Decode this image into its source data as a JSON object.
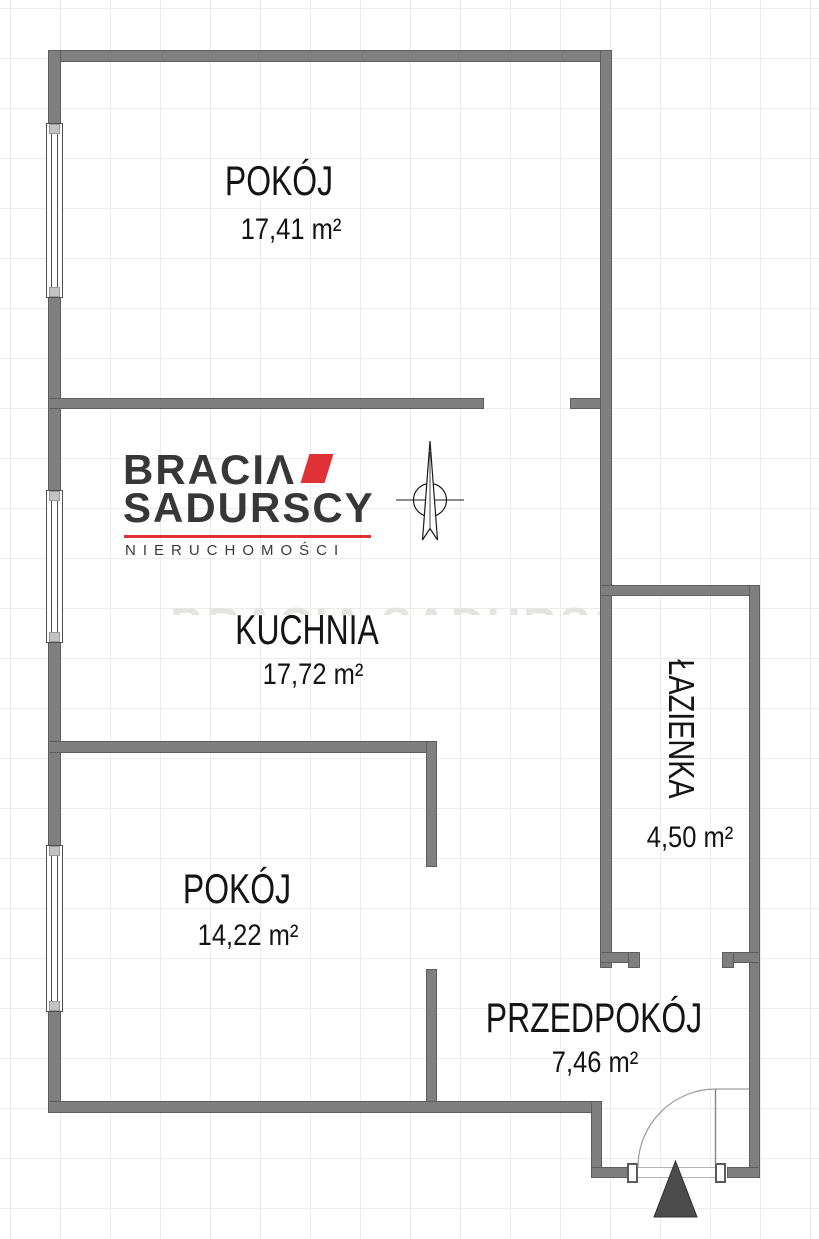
{
  "branding": {
    "logo_line1": "BRACIΛ",
    "logo_line2": "SADURSCY",
    "logo_tagline": "NIERUCHOMOŚCI",
    "watermark_text": "BRACIA SADURSCY"
  },
  "rooms": [
    {
      "name": "POKÓJ",
      "area": "17,41 m²"
    },
    {
      "name": "KUCHNIA",
      "area": "17,72 m²"
    },
    {
      "name": "POKÓJ",
      "area": "14,22 m²"
    },
    {
      "name": "ŁAZIENKA",
      "area": "4,50 m²"
    },
    {
      "name": "PRZEDPOKÓJ",
      "area": "7,46 m²"
    }
  ],
  "symbols": {
    "north_arrow": "compass-north-needle",
    "entrance_marker": "up-triangle",
    "entrance_door": "door-swing-arc-90deg",
    "window_symbol": "double-line-window"
  },
  "colors": {
    "wall": "#7f7f7f",
    "wall_edge": "#5e5e5e",
    "accent_red": "#e03236",
    "label_text": "#141414",
    "logo_text": "#373737",
    "grid_line": "#ececec",
    "triangle": "#4c4c4c"
  }
}
